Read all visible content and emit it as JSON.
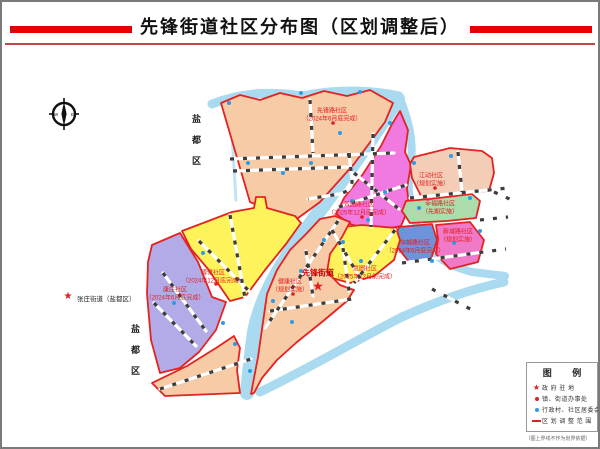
{
  "header": {
    "title": "先锋街道社区分布图（区划调整后）"
  },
  "compass": {
    "west": "W",
    "east": "E"
  },
  "districts": {
    "top": "盐都区",
    "bottom": "盐都区"
  },
  "neighbor": {
    "label": "张庄街道（盐都区）"
  },
  "street": {
    "name": "先锋街道"
  },
  "regions": [
    {
      "id": "xianfeng-lu",
      "name": "先锋路社区",
      "note": "（2024年6月底完成）",
      "color": "#F6CBA6"
    },
    {
      "id": "shuangyuan-lu",
      "name": "双园路社区",
      "note": "（2025年12月底完成）",
      "color": "#F07ADF"
    },
    {
      "id": "jiangdong",
      "name": "江动社区",
      "note": "（规划实施）",
      "color": "#F3CDB6"
    },
    {
      "id": "xingfu-lu",
      "name": "幸福路社区",
      "note": "（先期实施）",
      "color": "#ACDCAC"
    },
    {
      "id": "dongcheng-lu",
      "name": "东城路社区",
      "note": "（2024年6月底完成）",
      "color": "#6D93DB"
    },
    {
      "id": "xincheng-lu",
      "name": "新城路社区",
      "note": "（规划实施）",
      "color": "#F07AC8"
    },
    {
      "id": "siyuan",
      "name": "思圆社区",
      "note": "（2025年12月前完成）",
      "color": "#FFF35C"
    },
    {
      "id": "jiankang",
      "name": "健康社区",
      "note": "（规划实施）",
      "color": "#F6CBA6"
    },
    {
      "id": "boya",
      "name": "博雅社区",
      "note": "（2024年12月底完成）",
      "color": "#FFF35C"
    },
    {
      "id": "kangzhuang",
      "name": "康庄社区",
      "note": "（2024年6月底完成）",
      "color": "#B3ABE8"
    }
  ],
  "legend": {
    "title": "图  例",
    "items": [
      {
        "symbol": "star",
        "label": "政 府 驻 地"
      },
      {
        "symbol": "red-dot",
        "label": "镇、街道办事处"
      },
      {
        "symbol": "blue-dot",
        "label": "行政村、社区居委会"
      },
      {
        "symbol": "red-line",
        "label": "区 划 调 整 范 围"
      }
    ],
    "caption": "（图上界线不作为划界依据）"
  },
  "colors": {
    "boundary_red": "#E32222",
    "river_blue": "#A9DAEF",
    "title_bar_red": "#E60000",
    "village_dot_blue": "#2E9BE6",
    "office_dot_red": "#E02020"
  }
}
